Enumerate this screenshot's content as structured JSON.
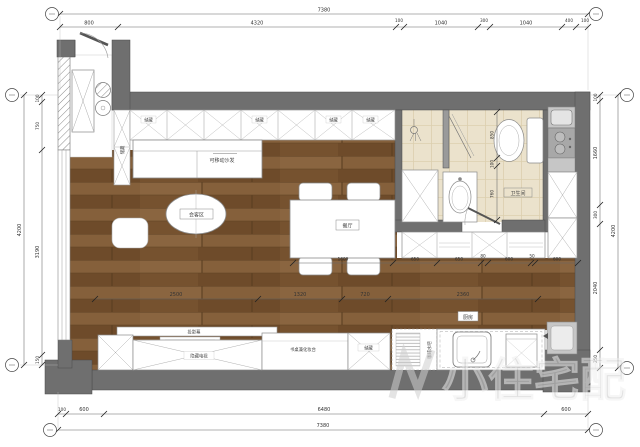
{
  "plan": {
    "labels": {
      "storage": "储藏",
      "sofa": "可移动沙发",
      "meeting_area": "会客区",
      "dining": "餐厅",
      "bathroom": "卫生间",
      "kitchen": "厨房",
      "projector_screen": "投影幕",
      "hidden_tv": "隐藏电视",
      "desk_vanity": "书桌兼化妆台",
      "water_bar": "咖啡水吧"
    },
    "dimensions": {
      "top_total": "7380",
      "top_segments": [
        "800",
        "4320",
        "100",
        "1040",
        "300",
        "1040",
        "400",
        "100"
      ],
      "bottom_segments": [
        "100",
        "600",
        "6480",
        "600"
      ],
      "bottom_total": "7380",
      "left_total": "4200",
      "left_segments": [
        "100",
        "750",
        "3190",
        "150"
      ],
      "right_total": "4200",
      "right_segments": [
        "100",
        "1660",
        "300",
        "2040",
        "250"
      ],
      "floor_segments": [
        "2500",
        "1320",
        "720",
        "2360"
      ],
      "cabinet_segments": [
        "1600",
        "650",
        "650",
        "80",
        "600",
        "50",
        "600"
      ],
      "bath_segments": [
        "850",
        "100",
        "760"
      ]
    },
    "watermark": "小住宅配",
    "colors": {
      "wall": "#6f6f6f",
      "wood": "#7c5733",
      "bath_floor": "#ebe2cc",
      "counter": "#c6c6c6"
    }
  }
}
